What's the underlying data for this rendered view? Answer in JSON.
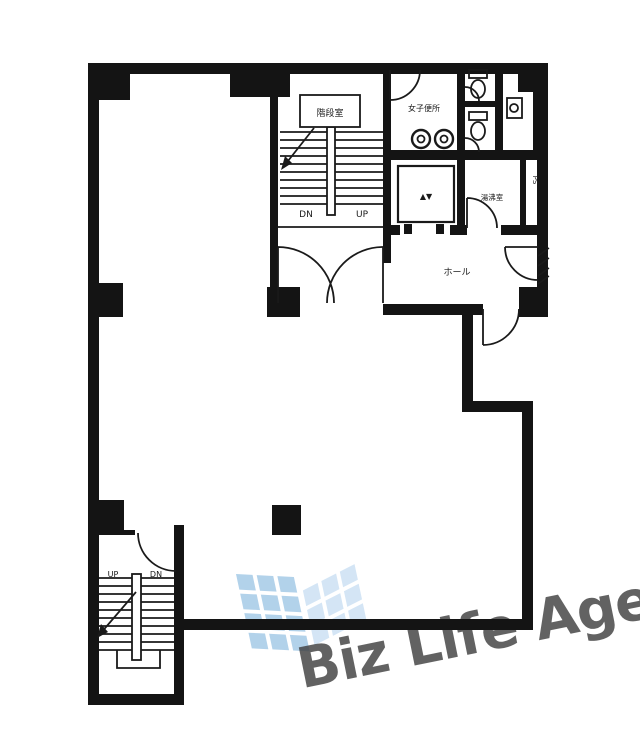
{
  "watermark": {
    "text": "Biz Life Agent",
    "text_color": "#aab6c3",
    "logo_color_left": "#8fbde1",
    "logo_color_right": "#c3dcf1"
  },
  "plan": {
    "wall_color": "#141414",
    "line_color": "#1a1a1a",
    "labels": {
      "stair_room": "階段室",
      "upper_stairs_dn": "DN",
      "upper_stairs_up": "UP",
      "womens_toilet": "女子便所",
      "elevator_mark": "▲▼",
      "kitchenette": "湯沸室",
      "pipe_space": "PS",
      "hall": "ホール",
      "lower_stairs_up": "UP",
      "lower_stairs_dn": "DN"
    }
  }
}
